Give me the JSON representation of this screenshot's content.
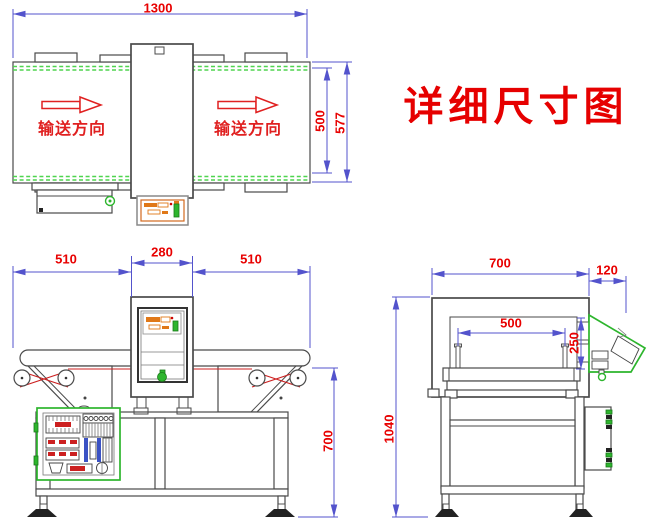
{
  "title": {
    "text": "详细尺寸图"
  },
  "colors": {
    "dimension_line": "#5353cc",
    "dimension_text": "#e80000",
    "machine_outline": "#4a4a4a",
    "accent_green": "#2db52d",
    "belt_guide_green": "#4fd44f",
    "panel_orange": "#e07818",
    "belt_red": "#cc2020"
  },
  "top_view": {
    "dim_length": "1300",
    "dim_belt_width": "500",
    "dim_overall_width": "577",
    "flow_label_left": "输送方向",
    "flow_label_right": "输送方向"
  },
  "front_view": {
    "dim_left_section": "510",
    "dim_detector_width": "280",
    "dim_right_section": "510",
    "dim_belt_height": "700"
  },
  "side_view": {
    "dim_body_depth": "700",
    "dim_panel_offset": "120",
    "dim_aperture_width": "500",
    "dim_aperture_height": "250",
    "dim_total_height": "1040"
  }
}
